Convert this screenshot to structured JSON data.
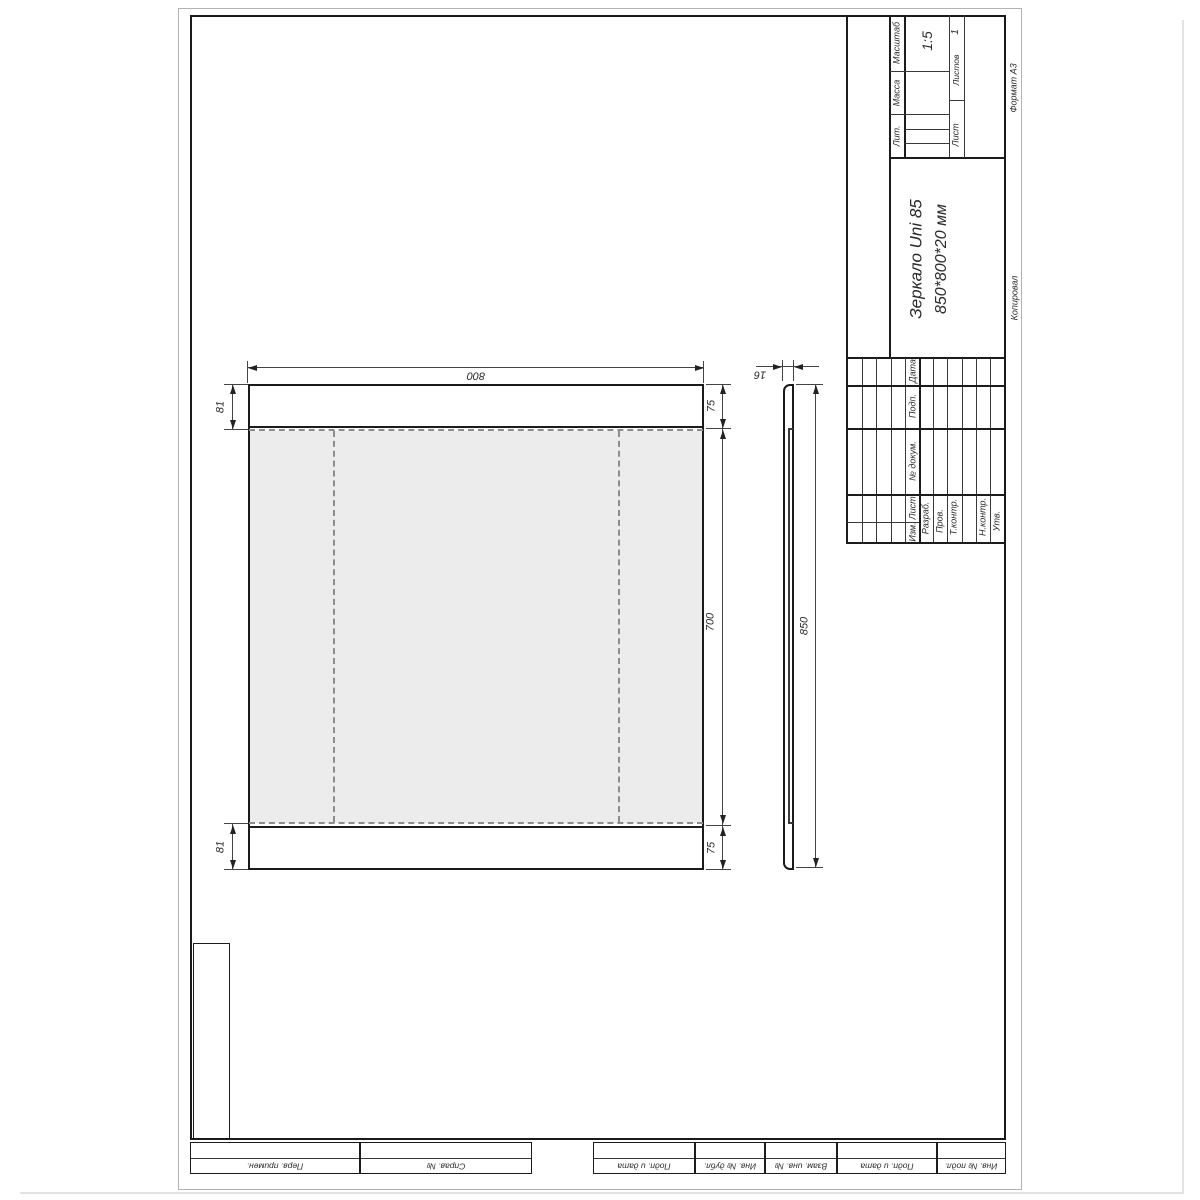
{
  "page": {
    "format_label": "Формат  А3",
    "copy_label": "Копировал"
  },
  "title_block": {
    "name": "Зеркало Uni 85",
    "dims_line": "850*800*20 мм",
    "scale_label": "Масштаб",
    "scale_value": "1:5",
    "mass_label": "Масса",
    "lit_label": "Лит.",
    "sheet_label": "Лист",
    "sheets_label": "Листов",
    "sheets_value": "1",
    "cols": {
      "izm": "Изм.",
      "list": "Лист",
      "doc": "№ докум.",
      "sign": "Подп.",
      "date": "Дата"
    },
    "rows": {
      "razrab": "Разраб.",
      "prov": "Пров.",
      "tkontr": "Т.контр.",
      "nkontr": "Н.контр.",
      "utv": "Утв."
    }
  },
  "margin_fields": {
    "perv": "Перв. примен.",
    "sprav": "Справ. №",
    "podp1": "Подп. и дата",
    "dubl": "Инв. № дубл.",
    "vzam": "Взам. инв. №",
    "podp2": "Подп. и дата",
    "podl": "Инв. № подл."
  },
  "dims": {
    "width": "800",
    "side_height": "850",
    "top_band": "75",
    "middle": "700",
    "bottom_band": "75",
    "inset_top": "81",
    "inset_bottom": "81",
    "thickness": "16"
  }
}
